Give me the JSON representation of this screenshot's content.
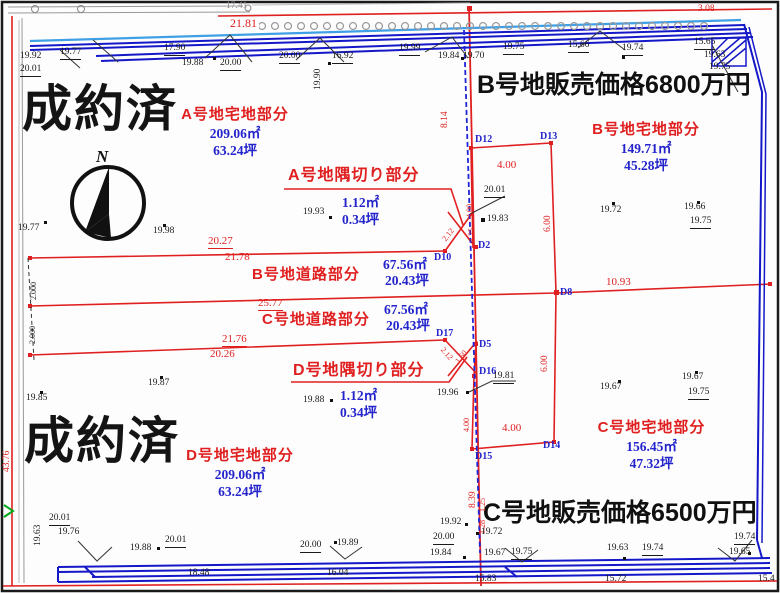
{
  "labels": {
    "sold_top": "成約済",
    "sold_bottom": "成約済",
    "price_b": "B号地販売価格6800万円",
    "price_c": "C号地販売価格6500万円",
    "compass_n": "N"
  },
  "plots": {
    "a": {
      "title": "A号地宅地部分",
      "m2": "209.06㎡",
      "tsubo": "63.24坪"
    },
    "a_corner": {
      "title": "A号地隅切り部分",
      "m2": "1.12㎡",
      "tsubo": "0.34坪"
    },
    "b": {
      "title": "B号地宅地部分",
      "m2": "149.71㎡",
      "tsubo": "45.28坪"
    },
    "b_road": {
      "title": "B号地道路部分",
      "m2": "67.56㎡",
      "tsubo": "20.43坪"
    },
    "c_road": {
      "title": "C号地道路部分",
      "m2": "67.56㎡",
      "tsubo": "20.43坪"
    },
    "d_corner": {
      "title": "D号地隅切り部分",
      "m2": "1.12㎡",
      "tsubo": "0.34坪"
    },
    "c": {
      "title": "C号地宅地部分",
      "m2": "156.45㎡",
      "tsubo": "47.32坪"
    },
    "d": {
      "title": "D号地宅地部分",
      "m2": "209.06㎡",
      "tsubo": "63.24坪"
    }
  },
  "points": {
    "d12": "D12",
    "d13": "D13",
    "d10": "D10",
    "d2": "D2",
    "d8": "D8",
    "d17": "D17",
    "d5": "D5",
    "d16": "D16",
    "d15": "D15",
    "d14": "D14"
  },
  "meas": {
    "t01": "17.41",
    "t02": "21.81",
    "t03": "3.08",
    "t04": "19.92",
    "t05": "20.01",
    "t06": "19.77",
    "t07": "17.90",
    "t08": "19.88",
    "t09": "20.00",
    "t10": "20.00",
    "t11": "16.92",
    "t12": "19.90",
    "t13": "19.99",
    "t14": "19.84",
    "t15": "19.70",
    "t16": "19.75",
    "t17": "15.66",
    "t18": "19.74",
    "t19": "15.65",
    "t20": "19.63",
    "t21": "19.75",
    "i01": "19.77",
    "i02": "19.98",
    "i03": "19.85",
    "i04": "19.87",
    "i05": "19.93",
    "i06": "19.88",
    "i07": "19.72",
    "i08": "19.66",
    "i09": "19.75",
    "i10": "19.67",
    "i11": "19.75",
    "i12": "19.67",
    "i13": "19.83",
    "i14": "20.01",
    "i15": "19.81",
    "i16": "19.96",
    "c01": "8.14",
    "c02": "4.00",
    "c03": "6.00",
    "c04": "4.00",
    "c05": "2.12",
    "c06": "1.25",
    "c07": "10.93",
    "c08": "6.00",
    "c09": "2.12",
    "c10": "1.50",
    "c11": "4.00",
    "c12": "8.39",
    "c13": "4.00",
    "c14": "20.27",
    "c15": "21.78",
    "c16": "25.77",
    "c17": "21.76",
    "c18": "20.26",
    "c19": "1.25",
    "c20": "1.28",
    "b01": "19.63",
    "b02": "20.01",
    "b03": "19.76",
    "b04": "19.88",
    "b05": "20.01",
    "b06": "18.48",
    "b07": "20.00",
    "b08": "19.89",
    "b09": "16.04",
    "b10": "19.92",
    "b11": "20.00",
    "b12": "19.84",
    "b13": "19.72",
    "b14": "19.67",
    "b15": "19.75",
    "b16": "15.83",
    "b17": "19.63",
    "b18": "19.74",
    "b19": "15.72",
    "b20": "19.74",
    "b21": "19.65",
    "b22": "15.4",
    "l01": "43.76",
    "l02": "2.000",
    "l03": "2.000"
  }
}
